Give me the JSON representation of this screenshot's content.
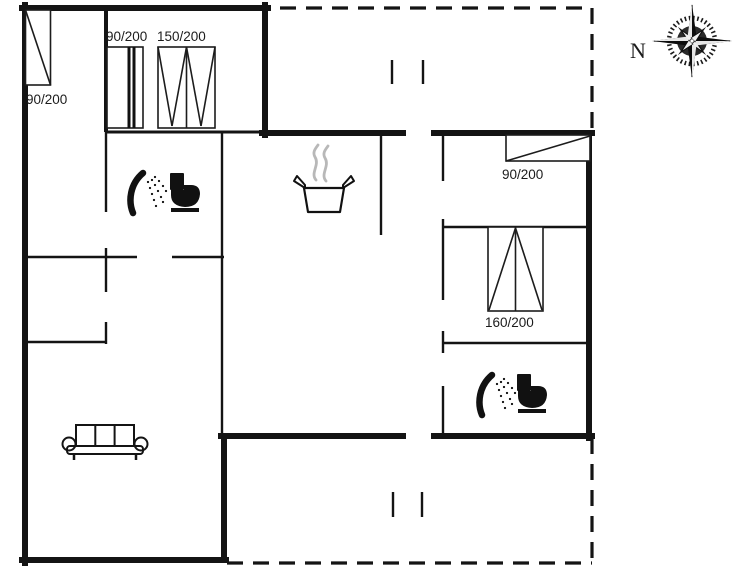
{
  "plan": {
    "type": "holiday-house floor plan",
    "compass": {
      "label": "N"
    },
    "windows": [
      {
        "label": "90/200",
        "position": "left-exterior-wall"
      },
      {
        "label": "90/200",
        "position": "top-room-small"
      },
      {
        "label": "150/200",
        "position": "top-room-large"
      },
      {
        "label": "90/200",
        "position": "right-wing-north-wall"
      },
      {
        "label": "160/200",
        "position": "right-wing-middle-wall"
      }
    ],
    "icons": [
      {
        "name": "shower-icon",
        "location": "bathroom-1"
      },
      {
        "name": "toilet-icon",
        "location": "bathroom-1"
      },
      {
        "name": "cooking-pot-icon",
        "location": "kitchen"
      },
      {
        "name": "sofa-icon",
        "location": "living-room"
      },
      {
        "name": "shower-icon",
        "location": "bathroom-2"
      },
      {
        "name": "toilet-icon",
        "location": "bathroom-2"
      },
      {
        "name": "compass-rose-icon",
        "location": "top-right"
      }
    ],
    "colors": {
      "wall": "#141414",
      "steam": "#b8b8b8",
      "background": "#ffffff"
    }
  }
}
